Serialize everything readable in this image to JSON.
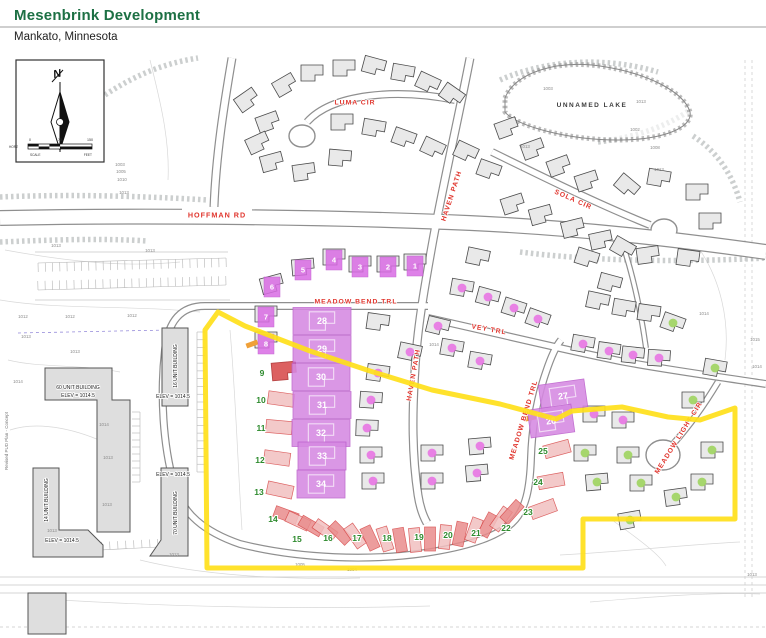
{
  "header": {
    "title": "Mesenbrink Development",
    "subtitle": "Mankato, Minnesota",
    "accent_color": "#1d7044"
  },
  "map": {
    "colors": {
      "street_label": "#e0342c",
      "boundary": "#ffe01a",
      "magenta_lot": "#d689e2",
      "magenta_square": "#d96ce4",
      "magenta_dot": "#e76fe3",
      "green_dot": "#9fd45f",
      "green_number": "#2e8b2e",
      "strip_pink": "#f2c0c0",
      "strip_red": "#e98c8c",
      "strip_stroke": "#d64545",
      "house_fill": "#e9e9e9",
      "building_fill": "#dedede",
      "road_casing": "#8f8f8f",
      "lake_label_color": "#3c3c3c"
    },
    "north_box": {
      "n": "N",
      "horz": "HORZ",
      "scale": "SCALE",
      "feet": "FEET",
      "t0": "0",
      "t75": "75",
      "t150": "150"
    },
    "lake_label": "UNNAMED LAKE",
    "margin_note": "Revised PUD Plan - Concept",
    "streets": [
      {
        "label": "HOFFMAN RD",
        "x": 217,
        "y": 215,
        "rot": 0,
        "boxed": true,
        "fs": 7.2
      },
      {
        "label": "LUMA CIR",
        "x": 355,
        "y": 103,
        "rot": 0,
        "fs": 6.8
      },
      {
        "label": "HAVEN PATH",
        "x": 452,
        "y": 196,
        "rot": -72,
        "fs": 6.8
      },
      {
        "label": "SOLA CIR",
        "x": 573,
        "y": 200,
        "rot": 24,
        "fs": 6.8
      },
      {
        "label": "MEADOW BEND TRL",
        "x": 356,
        "y": 302,
        "rot": 0,
        "fs": 6.8
      },
      {
        "label": "VEY TRL",
        "x": 489,
        "y": 330,
        "rot": 10,
        "fs": 6.8
      },
      {
        "label": "HAVEN PATH",
        "x": 414,
        "y": 375,
        "rot": -80,
        "fs": 6.8
      },
      {
        "label": "MEADOW BEND TRL",
        "x": 524,
        "y": 420,
        "rot": -73,
        "fs": 6.8
      },
      {
        "label": "MEADOW LIGHT CIR",
        "x": 679,
        "y": 438,
        "rot": -58,
        "fs": 6.8
      }
    ],
    "roads": [
      {
        "w": 16,
        "d": "M0,218 C150,215 330,217 470,223 C580,228 680,240 766,252"
      },
      {
        "w": 9,
        "d": "M232,58 C224,105 216,155 214,207"
      },
      {
        "w": 9,
        "d": "M470,58 C458,120 444,180 433,240 C424,290 417,330 415,370 C412,415 412,455 418,495 C420,508 423,516 427,523"
      },
      {
        "w": 8,
        "d": "M455,100 C395,88 332,94 307,122"
      },
      {
        "w": 8,
        "d": "M492,152 C545,178 600,205 650,225"
      },
      {
        "w": 8,
        "d": "M428,318 C500,334 565,350 625,362 C675,371 720,377 766,384"
      },
      {
        "w": 8,
        "d": "M428,306 L205,306 C180,306 168,322 165,350 C160,395 163,445 174,484 C182,514 205,532 240,544 C300,559 370,561 425,553 C465,547 495,538 512,523 C526,510 530,488 531,458 C532,428 537,398 546,372 C551,357 556,346 561,340"
      },
      {
        "w": 7,
        "d": "M718,382 C706,402 690,425 674,443"
      },
      {
        "w": 6,
        "d": "M622,242 C634,278 641,312 646,348"
      }
    ],
    "bulbs": [
      {
        "x": 302,
        "y": 136,
        "rx": 13,
        "ry": 11
      },
      {
        "x": 664,
        "y": 230,
        "rx": 13,
        "ry": 11
      },
      {
        "x": 663,
        "y": 455,
        "rx": 17,
        "ry": 15
      }
    ],
    "lake": {
      "d": "M505,98 C515,72 558,60 600,66 C648,73 684,92 690,112 C693,128 662,140 618,140 C568,140 516,126 505,112 Z",
      "label_x": 592,
      "label_y": 107
    },
    "boundary_points": "218,312 245,326 310,351 370,371 432,390 500,404 556,419 572,411 622,407 668,417 700,420 735,408 735,519 583,519 583,568 207,568 205,330",
    "houses_plain": [
      [
        285,
        85,
        -30
      ],
      [
        312,
        73,
        0
      ],
      [
        344,
        68,
        0
      ],
      [
        374,
        66,
        15
      ],
      [
        403,
        73,
        10
      ],
      [
        428,
        83,
        25
      ],
      [
        452,
        95,
        35
      ],
      [
        268,
        122,
        -20
      ],
      [
        342,
        122,
        0
      ],
      [
        374,
        128,
        10
      ],
      [
        404,
        138,
        20
      ],
      [
        433,
        148,
        25
      ],
      [
        272,
        162,
        -15
      ],
      [
        304,
        172,
        -8
      ],
      [
        340,
        158,
        5
      ],
      [
        247,
        100,
        -35
      ],
      [
        258,
        143,
        -25
      ],
      [
        507,
        128,
        -20
      ],
      [
        533,
        149,
        -20
      ],
      [
        559,
        166,
        -20
      ],
      [
        587,
        181,
        -18
      ],
      [
        513,
        204,
        -18
      ],
      [
        541,
        215,
        -15
      ],
      [
        573,
        228,
        -14
      ],
      [
        601,
        240,
        -12
      ],
      [
        627,
        186,
        40
      ],
      [
        659,
        178,
        10
      ],
      [
        697,
        192,
        0
      ],
      [
        710,
        221,
        0
      ],
      [
        688,
        258,
        8
      ],
      [
        648,
        255,
        -8
      ],
      [
        623,
        248,
        30
      ],
      [
        466,
        152,
        25
      ],
      [
        489,
        170,
        20
      ],
      [
        478,
        257,
        12
      ],
      [
        587,
        258,
        18
      ],
      [
        610,
        283,
        15
      ],
      [
        598,
        301,
        12
      ],
      [
        624,
        308,
        10
      ],
      [
        649,
        313,
        8
      ],
      [
        378,
        322,
        8
      ],
      [
        415,
        262,
        0
      ],
      [
        388,
        264,
        0
      ],
      [
        360,
        264,
        0
      ],
      [
        334,
        257,
        0
      ],
      [
        303,
        267,
        -5
      ],
      [
        272,
        284,
        -15
      ],
      [
        266,
        314,
        0
      ],
      [
        266,
        340,
        0
      ]
    ],
    "houses_magenta": [
      [
        462,
        288,
        10
      ],
      [
        488,
        297,
        15
      ],
      [
        514,
        308,
        18
      ],
      [
        538,
        319,
        20
      ],
      [
        583,
        344,
        10
      ],
      [
        609,
        351,
        8
      ],
      [
        633,
        355,
        6
      ],
      [
        659,
        358,
        4
      ],
      [
        438,
        326,
        14
      ],
      [
        452,
        348,
        10
      ],
      [
        410,
        352,
        12
      ],
      [
        480,
        361,
        10
      ],
      [
        378,
        373,
        8
      ],
      [
        371,
        400,
        4
      ],
      [
        367,
        428,
        2
      ],
      [
        371,
        455,
        0
      ],
      [
        373,
        481,
        0
      ],
      [
        432,
        453,
        0
      ],
      [
        432,
        481,
        0
      ],
      [
        480,
        446,
        -5
      ],
      [
        477,
        473,
        -5
      ],
      [
        594,
        414,
        0
      ],
      [
        623,
        420,
        0
      ]
    ],
    "houses_green": [
      [
        673,
        323,
        20
      ],
      [
        715,
        368,
        10
      ],
      [
        693,
        400,
        0
      ],
      [
        712,
        450,
        0
      ],
      [
        702,
        482,
        0
      ],
      [
        628,
        455,
        0
      ],
      [
        641,
        483,
        0
      ],
      [
        676,
        497,
        -8
      ],
      [
        585,
        453,
        0
      ],
      [
        597,
        482,
        -5
      ],
      [
        630,
        520,
        -10
      ]
    ],
    "lots_squares": [
      {
        "n": "1",
        "x": 415,
        "y": 266
      },
      {
        "n": "2",
        "x": 388,
        "y": 267
      },
      {
        "n": "3",
        "x": 360,
        "y": 267
      },
      {
        "n": "4",
        "x": 334,
        "y": 260
      },
      {
        "n": "5",
        "x": 303,
        "y": 270
      },
      {
        "n": "6",
        "x": 272,
        "y": 287
      },
      {
        "n": "7",
        "x": 266,
        "y": 317
      },
      {
        "n": "8",
        "x": 266,
        "y": 344
      }
    ],
    "lots_blocks": [
      {
        "n": "28",
        "x": 322,
        "y": 321,
        "w": 58,
        "h": 27,
        "r": 0
      },
      {
        "n": "29",
        "x": 322,
        "y": 349,
        "w": 58,
        "h": 27,
        "r": 0
      },
      {
        "n": "30",
        "x": 321,
        "y": 377,
        "w": 58,
        "h": 27,
        "r": 0
      },
      {
        "n": "31",
        "x": 322,
        "y": 405,
        "w": 58,
        "h": 27,
        "r": 0
      },
      {
        "n": "32",
        "x": 321,
        "y": 433,
        "w": 58,
        "h": 27,
        "r": 0
      },
      {
        "n": "33",
        "x": 322,
        "y": 456,
        "w": 48,
        "h": 28,
        "r": 0
      },
      {
        "n": "34",
        "x": 321,
        "y": 484,
        "w": 48,
        "h": 28,
        "r": 0
      },
      {
        "n": "27",
        "x": 563,
        "y": 396,
        "w": 46,
        "h": 28,
        "r": -8
      },
      {
        "n": "26",
        "x": 551,
        "y": 421,
        "w": 44,
        "h": 28,
        "r": -8
      }
    ],
    "lots_green": [
      {
        "n": "9",
        "x": 262,
        "y": 373
      },
      {
        "n": "10",
        "x": 261,
        "y": 400
      },
      {
        "n": "11",
        "x": 261,
        "y": 428
      },
      {
        "n": "12",
        "x": 260,
        "y": 460
      },
      {
        "n": "13",
        "x": 259,
        "y": 492
      },
      {
        "n": "14",
        "x": 273,
        "y": 519
      },
      {
        "n": "15",
        "x": 297,
        "y": 539
      },
      {
        "n": "16",
        "x": 328,
        "y": 538
      },
      {
        "n": "17",
        "x": 357,
        "y": 538
      },
      {
        "n": "18",
        "x": 387,
        "y": 538
      },
      {
        "n": "19",
        "x": 419,
        "y": 537
      },
      {
        "n": "20",
        "x": 448,
        "y": 535
      },
      {
        "n": "21",
        "x": 476,
        "y": 533
      },
      {
        "n": "22",
        "x": 506,
        "y": 528
      },
      {
        "n": "23",
        "x": 528,
        "y": 512
      },
      {
        "n": "24",
        "x": 538,
        "y": 482
      },
      {
        "n": "25",
        "x": 543,
        "y": 451
      }
    ],
    "strips_arc": [
      [
        286,
        515,
        -70
      ],
      [
        298,
        521,
        -65
      ],
      [
        311,
        526,
        -60
      ],
      [
        325,
        530,
        -55
      ],
      [
        340,
        533,
        -45
      ],
      [
        355,
        536,
        -35
      ],
      [
        370,
        538,
        -25
      ],
      [
        385,
        539,
        -18
      ],
      [
        400,
        540,
        -10
      ],
      [
        415,
        540,
        -5
      ],
      [
        430,
        539,
        0
      ],
      [
        445,
        537,
        5
      ],
      [
        460,
        534,
        12
      ],
      [
        474,
        530,
        20
      ],
      [
        488,
        525,
        28
      ],
      [
        501,
        519,
        35
      ],
      [
        512,
        512,
        42
      ]
    ],
    "strips_side": [
      [
        281,
        399,
        8
      ],
      [
        279,
        427,
        5
      ],
      [
        277,
        458,
        8
      ],
      [
        280,
        490,
        12
      ],
      [
        557,
        449,
        -15
      ],
      [
        551,
        481,
        -10
      ],
      [
        543,
        509,
        -20
      ]
    ],
    "red_house": [
      284,
      371,
      -5
    ],
    "orange_ticks": [
      [
        252,
        344,
        -20
      ],
      [
        530,
        418,
        -12
      ]
    ],
    "buildings": [
      "M45,368 H112 V400 H130 V532 H97 V400 H45 Z",
      "M162,328 H188 V406 H162 Z",
      "M161,468 H188 V556 H150 L161,540 Z",
      "M33,468 H59 V530 L88,530 L103,545 V557 H33 Z",
      "M28,593 H66 V634 H28 Z"
    ],
    "building_labels": [
      {
        "t": "60 UNIT BUILDING",
        "x": 78,
        "y": 388,
        "r": 0
      },
      {
        "t": "ELEV = 1014.5",
        "x": 78,
        "y": 396,
        "r": 0
      },
      {
        "t": "16 UNIT BUILDING",
        "x": 176,
        "y": 366,
        "r": -90
      },
      {
        "t": "ELEV = 1014.5",
        "x": 173,
        "y": 397,
        "r": 0
      },
      {
        "t": "70 UNIT BUILDING",
        "x": 176,
        "y": 513,
        "r": -90
      },
      {
        "t": "ELEV = 1014.5",
        "x": 173,
        "y": 475,
        "r": 0
      },
      {
        "t": "14 UNIT BUILDING",
        "x": 47,
        "y": 500,
        "r": -90
      },
      {
        "t": "ELEV = 1014.5",
        "x": 62,
        "y": 541,
        "r": 0
      }
    ],
    "elevations": [
      [
        120,
        166,
        "1003"
      ],
      [
        121,
        173,
        "1005"
      ],
      [
        122,
        181,
        "1010"
      ],
      [
        124,
        194,
        "1013"
      ],
      [
        56,
        247,
        "1013"
      ],
      [
        150,
        252,
        "1013"
      ],
      [
        23,
        318,
        "1012"
      ],
      [
        70,
        318,
        "1012"
      ],
      [
        132,
        317,
        "1012"
      ],
      [
        26,
        338,
        "1013"
      ],
      [
        75,
        353,
        "1013"
      ],
      [
        18,
        383,
        "1014"
      ],
      [
        104,
        426,
        "1014"
      ],
      [
        108,
        459,
        "1013"
      ],
      [
        107,
        506,
        "1013"
      ],
      [
        52,
        532,
        "1013"
      ],
      [
        174,
        556,
        "1013"
      ],
      [
        548,
        90,
        "1003"
      ],
      [
        641,
        103,
        "1013"
      ],
      [
        635,
        131,
        "1002"
      ],
      [
        655,
        149,
        "1008"
      ],
      [
        659,
        171,
        "1013"
      ],
      [
        525,
        148,
        "1013"
      ],
      [
        704,
        315,
        "1014"
      ],
      [
        755,
        341,
        "1015"
      ],
      [
        434,
        346,
        "1014"
      ],
      [
        757,
        368,
        "1014"
      ],
      [
        300,
        566,
        "1005"
      ],
      [
        352,
        571,
        "1004"
      ],
      [
        752,
        576,
        "1013"
      ]
    ],
    "contours": [
      "M5,250 C60,260 120,268 180,262",
      "M0,300 C60,310 130,305 200,312",
      "M10,430 C40,420 80,430 112,446",
      "M8,360 C40,368 80,364 120,372",
      "M140,560 C200,575 280,580 360,578",
      "M560,555 C620,552 680,545 740,542",
      "M590,602 C650,597 710,592 760,594",
      "M700,250 C720,280 730,320 725,360",
      "M150,60 C160,100 170,140 168,180",
      "M612,520 C640,540 660,555 666,566",
      "M230,330 C236,400 238,470 242,530",
      "M60,600 C160,606 300,610 430,606"
    ],
    "deco_lines": [
      {
        "d": "M0,577 H766",
        "dash": 0
      },
      {
        "d": "M0,585 H766",
        "dash": 0
      },
      {
        "d": "M0,593 H766",
        "dash": 0
      },
      {
        "d": "M745,60 V600",
        "dash": 1
      },
      {
        "d": "M752,60 V600",
        "dash": 1
      },
      {
        "d": "M0,627 H766",
        "dash": 1
      },
      {
        "d": "M35,252 H228",
        "dash": 0
      },
      {
        "d": "M35,300 H230",
        "dash": 0
      },
      {
        "d": "M18,333 L168,330",
        "dash": 2
      }
    ],
    "shrubs": [
      "M105,95 C135,75 165,63 198,58",
      "M0,197 C70,194 140,196 208,200",
      "M0,242 C50,240 100,238 148,241",
      "M500,80 C545,60 605,56 658,72",
      "M598,142 C640,137 670,124 690,110",
      "M693,136 C718,152 733,176 740,202",
      "M520,252 C600,262 690,262 766,258"
    ],
    "combs": [
      {
        "x1": 38,
        "y1": 263,
        "x2": 226,
        "y2": 258,
        "n": 26,
        "len": 9
      },
      {
        "x1": 38,
        "y1": 290,
        "x2": 226,
        "y2": 285,
        "n": 26,
        "len": -9
      },
      {
        "x1": 140,
        "y1": 412,
        "x2": 140,
        "y2": 482,
        "n": 10,
        "len": 8
      },
      {
        "x1": 197,
        "y1": 332,
        "x2": 197,
        "y2": 472,
        "n": 18,
        "len": -8
      },
      {
        "x1": 62,
        "y1": 552,
        "x2": 158,
        "y2": 547,
        "n": 12,
        "len": -8
      }
    ]
  }
}
